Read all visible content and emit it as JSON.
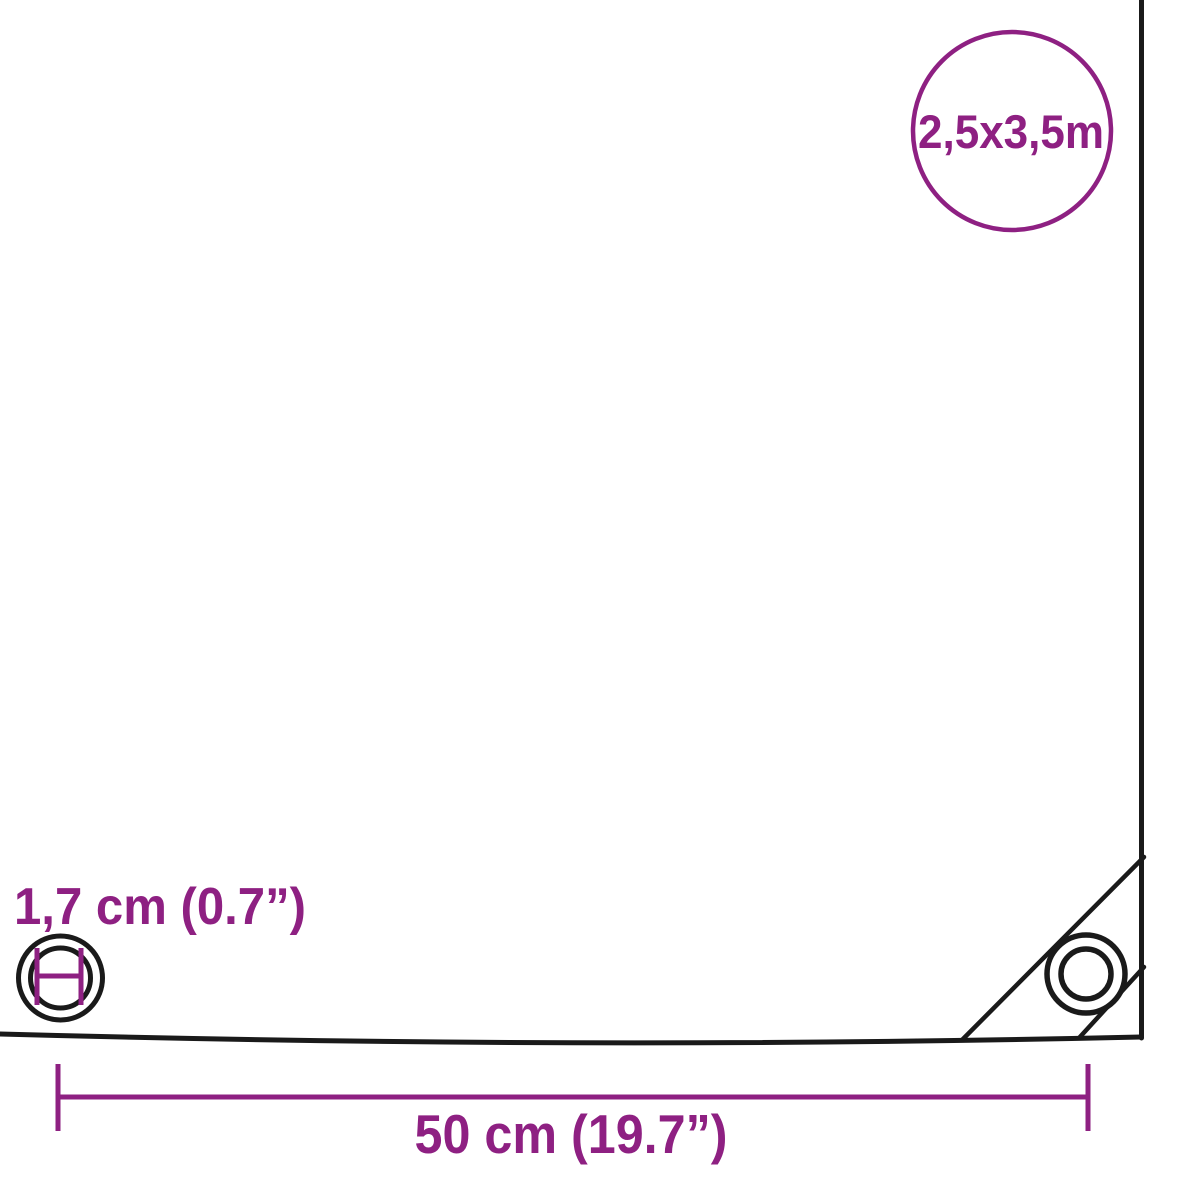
{
  "colors": {
    "accent": "#8E2082",
    "line": "#1A1A1A",
    "background": "#FFFFFF"
  },
  "size_badge": {
    "label": "2,5x3,5m"
  },
  "eyelet_diameter": {
    "label": "1,7 cm (0.7”)"
  },
  "eyelet_spacing": {
    "label": "50 cm (19.7”)"
  },
  "icons": {
    "size_badge_icon": "circle-outline-badge",
    "eyelet_diameter_icon": "concentric-rings-with-inner-diameter-marker",
    "corner_eyelet_icon": "concentric-rings-eyelet"
  }
}
